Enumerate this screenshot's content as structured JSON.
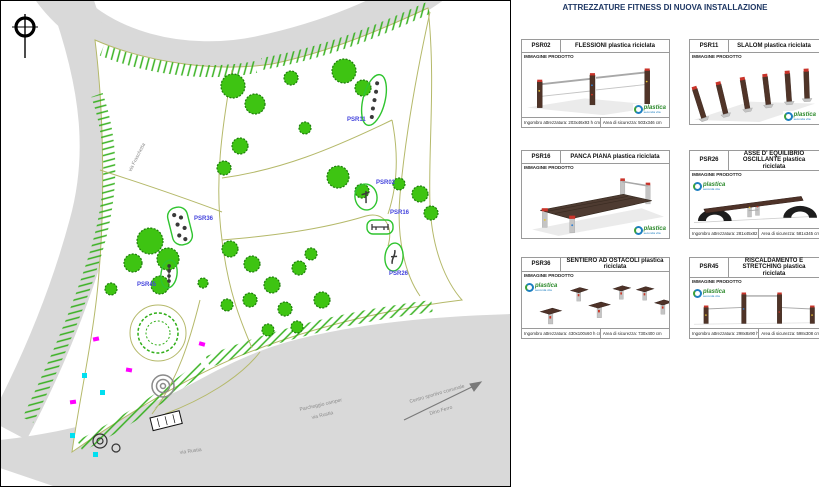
{
  "panel": {
    "title": "ATTREZZATURE FITNESS DI NUOVA INSTALLAZIONE",
    "image_label": "IMMAGINE PRODOTTO",
    "logo": {
      "name": "plastica",
      "sub": "seconda vita"
    },
    "cards": [
      {
        "code": "PSR02",
        "title": "FLESSIONI plastica riciclata",
        "footer_left": "Ingombro attrezzatura: 203x46x93 h cm",
        "footer_right": "Area di sicurezza: 503x346 cm"
      },
      {
        "code": "PSR11",
        "title": "SLALOM plastica riciclata"
      },
      {
        "code": "PSR16",
        "title": "PANCA PIANA plastica riciclata"
      },
      {
        "code": "PSR26",
        "title": "ASSE D' EQUILIBRIO OSCILLANTE plastica riciclata",
        "footer_left": "Ingombro attrezzatura: 281x45x82 h cm",
        "footer_right": "Area di sicurezza: 581x345 cm"
      },
      {
        "code": "PSR36",
        "title": "SENTIERO AD OSTACOLI plastica riciclata",
        "footer_left": "Ingombro attrezzatura: 430x100x60 h cm",
        "footer_right": "Area di sicurezza: 730x400 cm"
      },
      {
        "code": "PSR45",
        "title": "RISCALDAMENTO E STRETCHING plastica riciclata",
        "footer_left": "Ingombro attrezzatura: 298x8x90 h cm",
        "footer_right": "Area di sicurezza: 598x308 cm"
      }
    ]
  },
  "map": {
    "markers": [
      {
        "id": "PSR11"
      },
      {
        "id": "PSR02"
      },
      {
        "id": "PSR16"
      },
      {
        "id": "PSR36"
      },
      {
        "id": "PSR45"
      },
      {
        "id": "PSR26"
      }
    ],
    "streets": {
      "left_road": "via Fraschetta",
      "bottom_road": "via Rustia",
      "parking_line1": "Parcheggio camper",
      "parking_line2": "via Rustia",
      "arrow_line1": "Centro sportivo comunale",
      "arrow_line2": "Dino Ferro"
    },
    "colors": {
      "tree": "#3ec412",
      "marker_outline": "#2fc42f",
      "marker_label": "#4444dd",
      "road": "#d9d9d9",
      "path": "#b5b96a",
      "magenta": "#ff00ff",
      "cyan": "#00dff0"
    }
  }
}
